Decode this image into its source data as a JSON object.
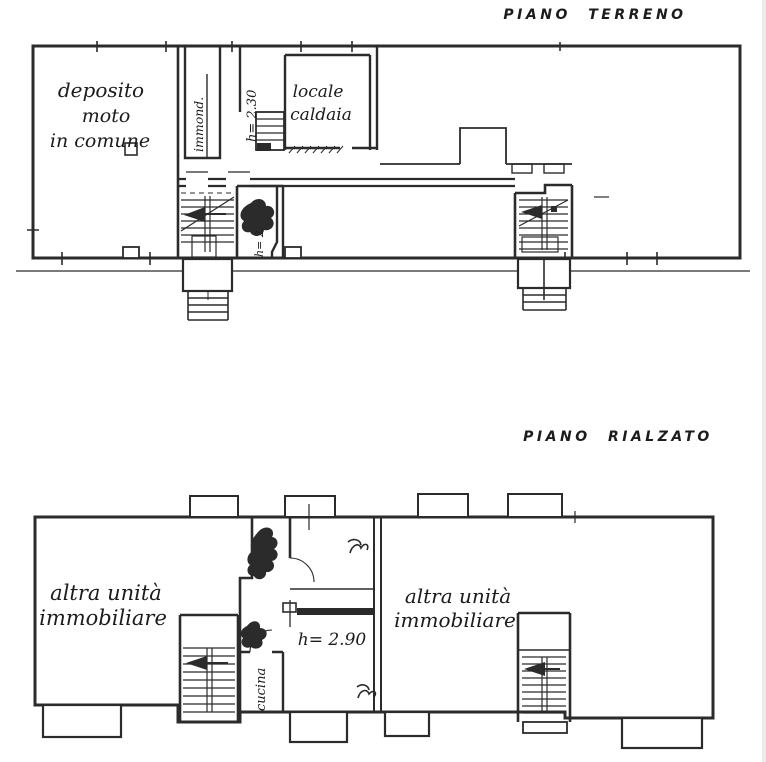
{
  "colors": {
    "ink": "#2b2b2b",
    "paper": "#ffffff",
    "ground_line": "#999999"
  },
  "ground_floor": {
    "title": "PIANO TERRENO",
    "labels": {
      "deposito": [
        "deposito",
        "moto",
        "in comune"
      ],
      "immond": "immond.",
      "height_caldaia": "h= 2.30",
      "caldaia": [
        "locale",
        "caldaia"
      ],
      "height_small_room": "h= 2."
    }
  },
  "raised_floor": {
    "title": "PIANO RIALZATO",
    "labels": {
      "left_unit": [
        "altra unità",
        "immobiliare"
      ],
      "right_unit": [
        "altra unità",
        "immobiliare"
      ],
      "height_room": "h= 2.90",
      "cucina": "cucina"
    }
  }
}
